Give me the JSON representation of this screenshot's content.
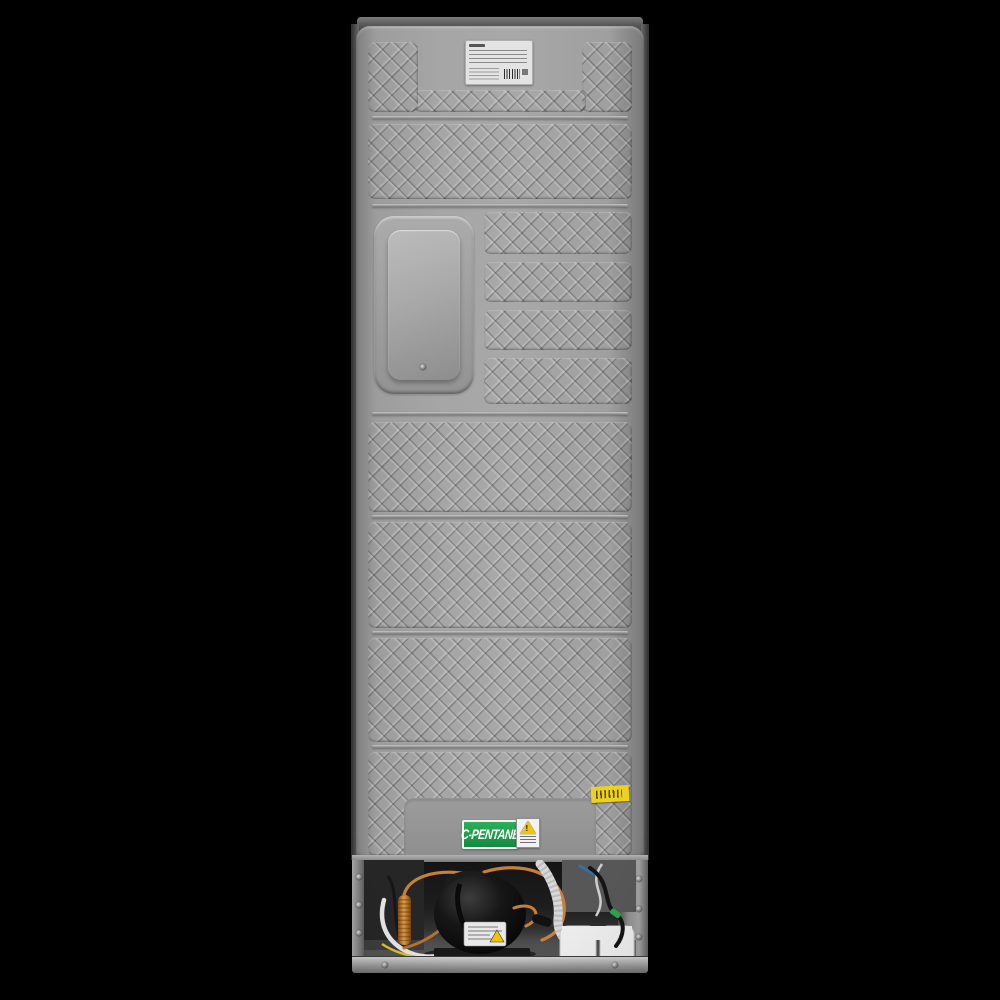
{
  "photo": {
    "subject": "refrigerator rear view product photo",
    "background_color": "#000000"
  },
  "cabinet": {
    "panel_base_color": "#a2a2a2",
    "texture": "diamond-embossed-metal",
    "top_cap_color": "#5a5a5a"
  },
  "stickers": {
    "rating_plate": {
      "background": "#e3e3e3",
      "barcode": true,
      "text_legible": false
    },
    "c_pentane": {
      "text": "C-PENTANE",
      "background": "#1f9e4e",
      "text_color": "#ffffff"
    },
    "warning": {
      "glyph": "!",
      "triangle_color": "#f1c40f",
      "background": "#f2f2f2"
    },
    "yellow_barcode": {
      "background": "#ecd11f"
    }
  },
  "machine_bay": {
    "compressor_color": "#0d0d0d",
    "copper_tube_color": "#c6803a",
    "drier_filter_color": "#c98435",
    "drain_hose_color": "#d8d8d8",
    "drain_tray_color": "#ededed",
    "green_connector_color": "#2fa34e",
    "rail_color": "#b5b5b5"
  }
}
